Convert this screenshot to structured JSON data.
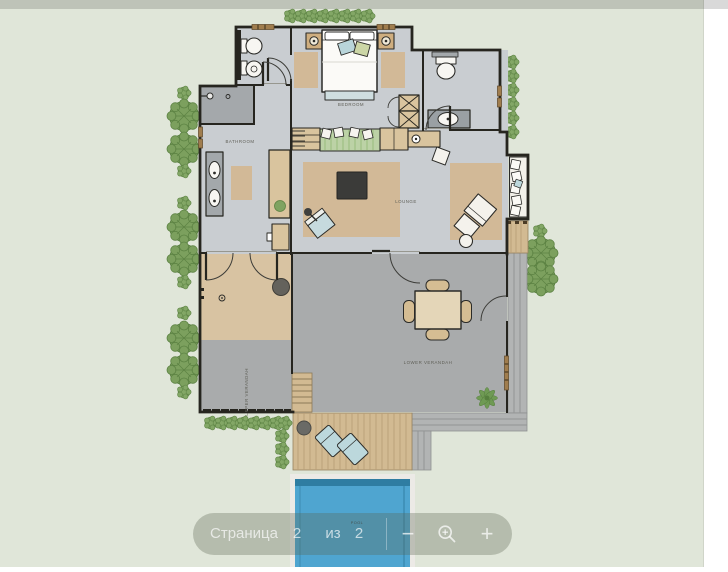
{
  "toolbar": {
    "page_label": "Страница",
    "current_page": "2",
    "of_label": "из",
    "total_pages": "2",
    "zoom_out": "−",
    "zoom_in": "+"
  },
  "floor_plan": {
    "labels": {
      "bedroom": "BEDROOM",
      "bathroom": "BATHROOM",
      "lounge": "LOUNGE",
      "upper_verandah": "UPPER VERANDAH",
      "lower_verandah": "LOWER VERANDAH",
      "pool": "POOL"
    },
    "colors": {
      "page_background": "#e0e6d9",
      "floor": "#c9cdd1",
      "shower_floor": "#a4a8ab",
      "verandah": "#a9abac",
      "upper_verandah_tan": "#d8c3a2",
      "rug": "#d2b997",
      "wood": "#d2ba92",
      "pool_water": "#4fa5d0",
      "pool_edge": "#2f7da2",
      "tree_green": "#7ca05e",
      "wall": "#26251f"
    }
  }
}
